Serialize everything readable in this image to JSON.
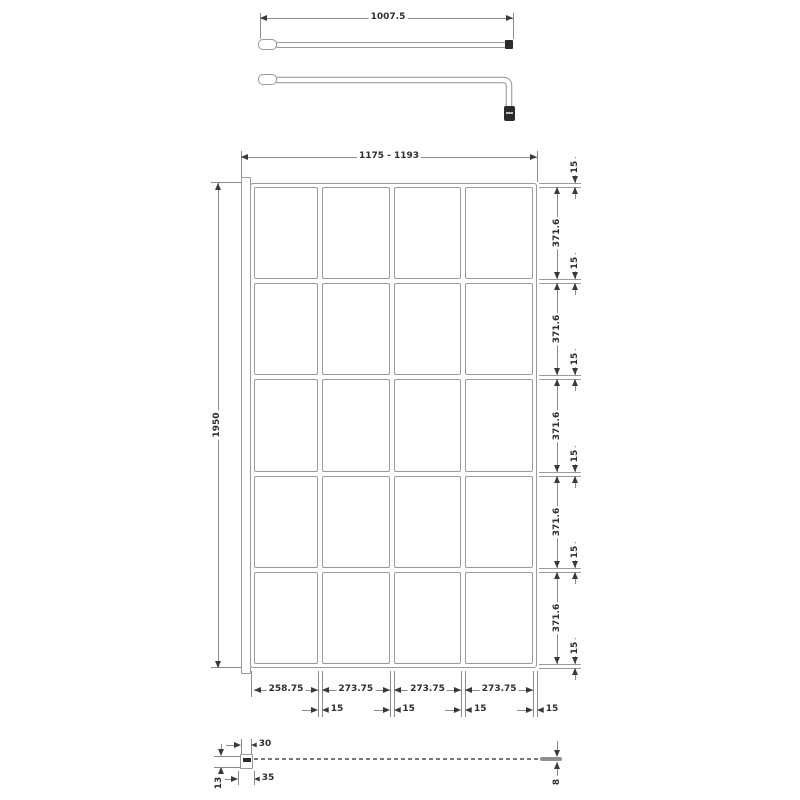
{
  "title": "Walk-in shower screen technical drawing",
  "support_bar": {
    "length": "1007.5"
  },
  "elevation": {
    "overall_width": "1175 - 1193",
    "overall_height": "1950",
    "columns": 4,
    "rows": 5,
    "panel_heights": [
      "371.6",
      "371.6",
      "371.6",
      "371.6",
      "371.6"
    ],
    "frame_bar_thicknesses": [
      "15",
      "15",
      "15",
      "15",
      "15",
      "15"
    ],
    "panel_widths": [
      "258.75",
      "273.75",
      "273.75",
      "273.75"
    ],
    "mullion_thicknesses": [
      "15",
      "15",
      "15",
      "15"
    ]
  },
  "plan": {
    "wall_profile_inner_width": "30",
    "wall_profile_depth": "13",
    "wall_profile_outer_width": "35",
    "glass_thickness": "8"
  },
  "colors": {
    "line": "#9a9a9a",
    "dim_line": "#8a8a8a",
    "text": "#3a3a3a",
    "dark": "#2b2b2b",
    "background": "#ffffff"
  }
}
